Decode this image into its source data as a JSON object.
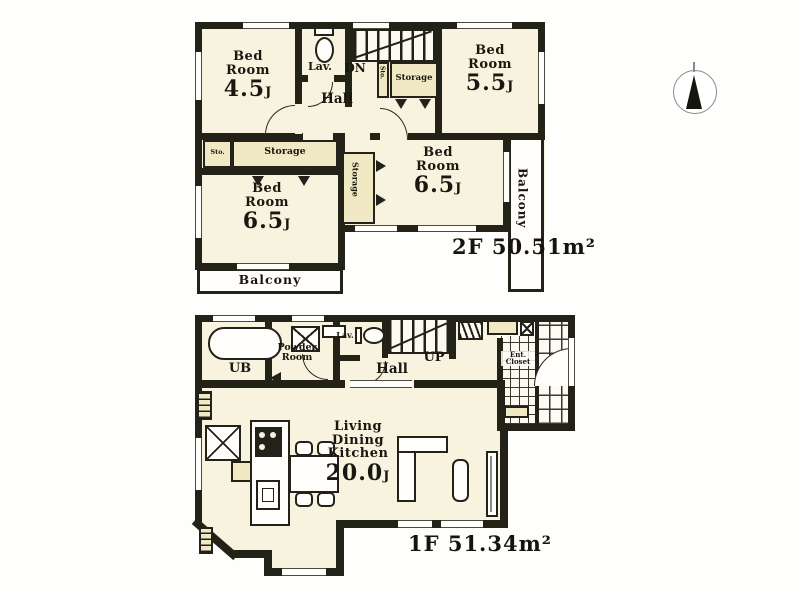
{
  "floor2": {
    "area_label": "2F 50.51m²",
    "bedroom_nw": {
      "name_line1": "Bed",
      "name_line2": "Room",
      "size": "4.5",
      "size_unit": "J"
    },
    "bedroom_ne": {
      "name_line1": "Bed",
      "name_line2": "Room",
      "size": "5.5",
      "size_unit": "J"
    },
    "bedroom_sw": {
      "name_line1": "Bed",
      "name_line2": "Room",
      "size": "6.5",
      "size_unit": "J"
    },
    "bedroom_se": {
      "name_line1": "Bed",
      "name_line2": "Room",
      "size": "6.5",
      "size_unit": "J"
    },
    "hall_label": "Hall",
    "lavatory_label": "Lav.",
    "stairs_label": "DN",
    "storage_top_label": "Storage",
    "storage_left_label": "Storage",
    "storage_mid_label": "Storage",
    "closet_small_label": "Sto.",
    "closet_stair_label": "Sto.",
    "balcony_south_label": "Balcony",
    "balcony_east_label": "Balcony"
  },
  "floor1": {
    "area_label": "1F 51.34m²",
    "bath_label": "UB",
    "powder_line1": "Powder",
    "powder_line2": "Room",
    "lavatory_label": "Lav.",
    "hall_label": "Hall",
    "stairs_label": "UP",
    "entrance_line1": "Ent.",
    "entrance_line2": "Closet",
    "ldk": {
      "name_line1": "Living",
      "name_line2": "Dining",
      "name_line3": "Kitchen",
      "size": "20.0",
      "size_unit": "J"
    },
    "niche_top_label": "Sto.",
    "niche_bottom_label": "Sto."
  }
}
